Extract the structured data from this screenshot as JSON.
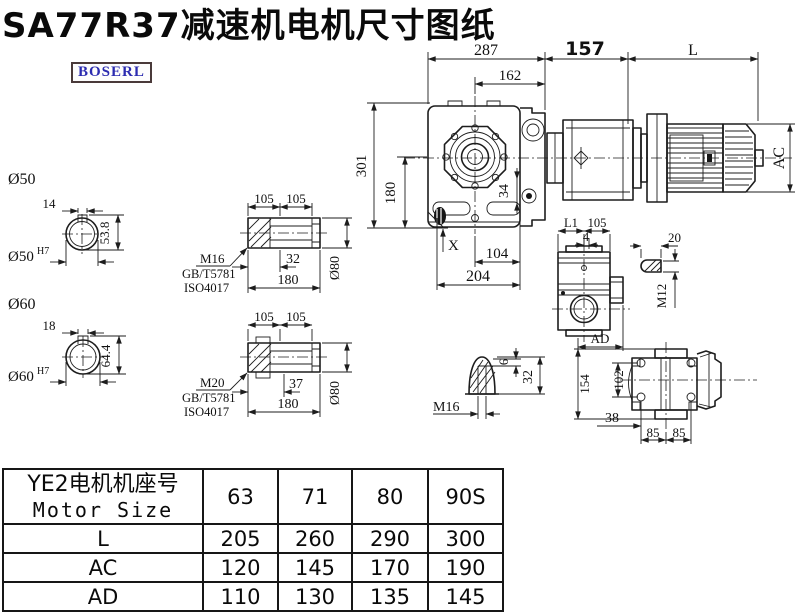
{
  "title": "SA77R37减速机电机尺寸图纸",
  "logo": "BOSERL",
  "drawing": {
    "main": {
      "w287": "287",
      "w162": "162",
      "w157": "157",
      "wL": "L",
      "hAC": "AC",
      "h301": "301",
      "h180": "180",
      "d34": "34",
      "x_mark": "X",
      "w104": "104",
      "w204": "204"
    },
    "shaft_top": {
      "dia": "Ø50",
      "key_w": "14",
      "depth": "53.8",
      "bore": "Ø50",
      "tol": "H7"
    },
    "shaft_bottom": {
      "dia": "Ø60",
      "key_w": "18",
      "depth": "64.4",
      "bore": "Ø60",
      "tol": "H7"
    },
    "sleeve_top": {
      "d1": "105",
      "d2": "105",
      "key_len": "32",
      "len": "180",
      "dia": "Ø80",
      "bolt": "M16",
      "std1": "GB/T5781",
      "std2": "ISO4017"
    },
    "sleeve_bottom": {
      "d1": "105",
      "d2": "105",
      "key_len": "37",
      "len": "180",
      "dia": "Ø80",
      "bolt": "M20",
      "std1": "GB/T5781",
      "std2": "ISO4017"
    },
    "side_view": {
      "l1": "L1",
      "w105": "105",
      "w4": "4",
      "ad": "AD"
    },
    "key_pin": {
      "len": "20",
      "thread": "M12"
    },
    "plug": {
      "thread": "M16",
      "h6": "6",
      "h32": "32"
    },
    "rear_view": {
      "h154": "154",
      "h102": "102",
      "w38": "38",
      "w85a": "85",
      "w85b": "85"
    }
  },
  "table": {
    "header_cn": "YE2电机机座号",
    "header_en": "Motor Size",
    "columns": [
      "63",
      "71",
      "80",
      "90S"
    ],
    "rows": [
      {
        "label": "L",
        "values": [
          "205",
          "260",
          "290",
          "300"
        ]
      },
      {
        "label": "AC",
        "values": [
          "120",
          "145",
          "170",
          "190"
        ]
      },
      {
        "label": "AD",
        "values": [
          "110",
          "130",
          "135",
          "145"
        ]
      }
    ]
  }
}
